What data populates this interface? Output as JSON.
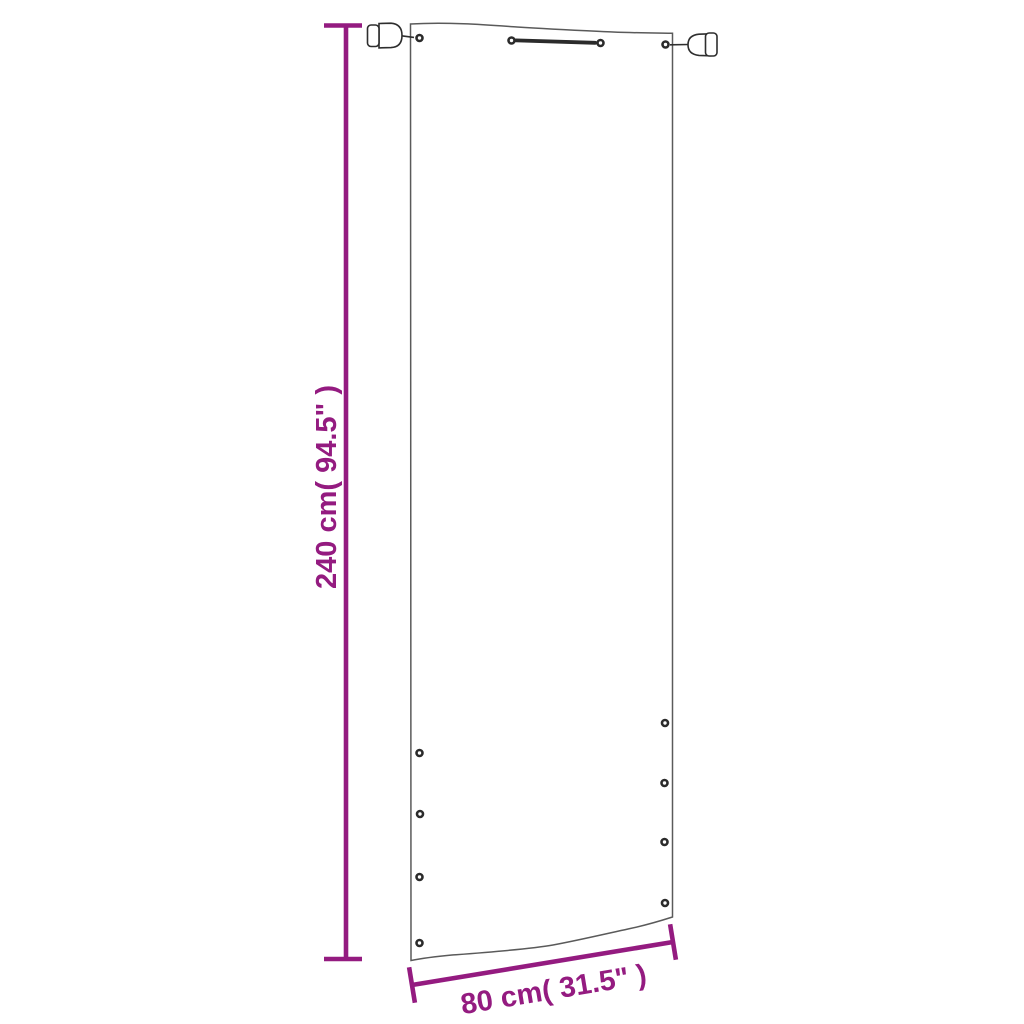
{
  "diagram": {
    "type": "product-dimension-diagram",
    "subject": "balcony privacy screen panel with grommets and mounting clamps",
    "accent_color": "#941b80",
    "outline_color": "#5a5a5a",
    "hardware_color": "#2e2e2e",
    "vertical_dimension": {
      "label": "240 cm( 94.5\" )",
      "value_cm": 240,
      "value_in": 94.5
    },
    "horizontal_dimension": {
      "label": "80 cm( 31.5\" )",
      "value_cm": 80,
      "value_in": 31.5
    },
    "grommet_count": 12
  }
}
